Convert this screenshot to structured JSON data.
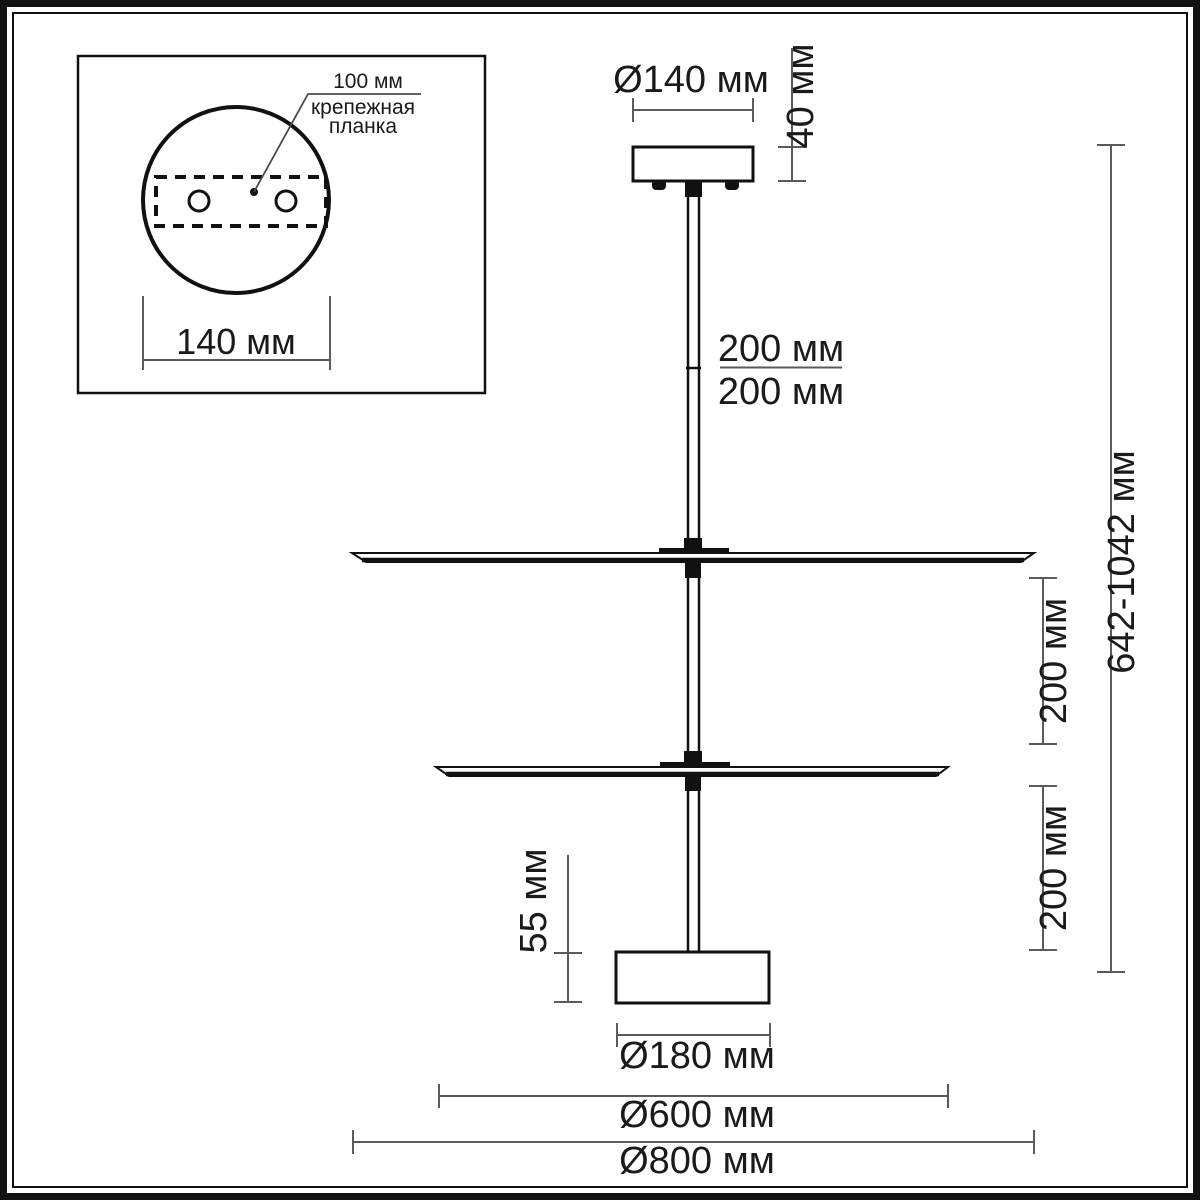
{
  "colors": {
    "background": "#ffffff",
    "drawing_line": "#111111",
    "dimension_line": "#5a5a5a",
    "text": "#1a1a1a"
  },
  "inset": {
    "hole_spacing": "100 мм",
    "bracket_line1": "крепежная",
    "bracket_line2": "планка",
    "plate_diameter": "140 мм"
  },
  "main": {
    "canopy_diameter": "Ø140 мм",
    "canopy_height": "40 мм",
    "rod_top_segment": "200 мм",
    "rod_bottom_segment": "200 мм",
    "overall_height": "642-1042 мм",
    "gap_disc1_disc2": "200 мм",
    "gap_disc2_base": "200 мм",
    "base_height": "55 мм",
    "base_diameter": "Ø180 мм",
    "middle_disc_diameter": "Ø600 мм",
    "top_disc_diameter": "Ø800 мм"
  }
}
